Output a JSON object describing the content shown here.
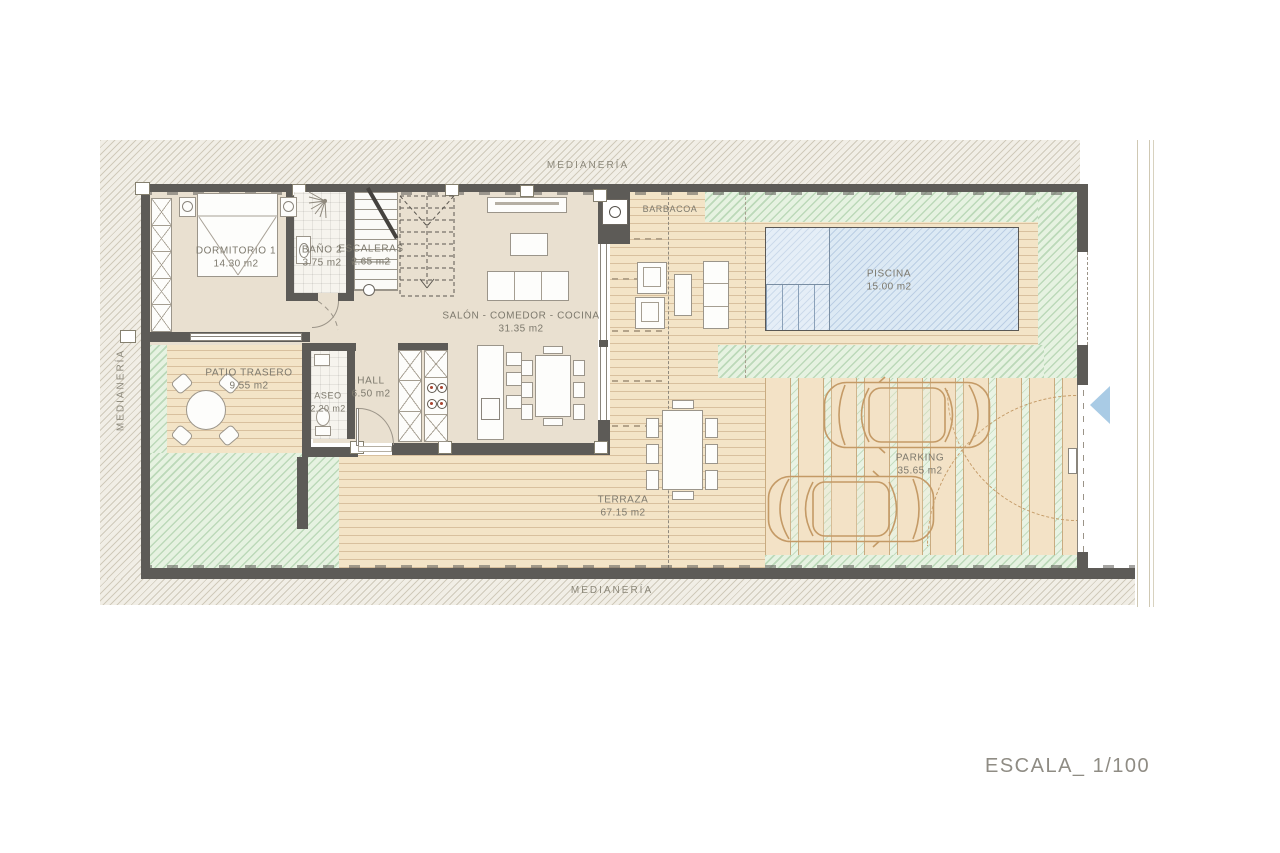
{
  "drawing": {
    "scale_label": "ESCALA_ 1/100",
    "boundary_top": "MEDIANERÍA",
    "boundary_left": "MEDIANERÍA",
    "boundary_bottom": "MEDIANERÍA"
  },
  "rooms": {
    "dormitorio1": {
      "name": "DORMITORIO 1",
      "area": "14.30 m2"
    },
    "bano2": {
      "name": "BAÑO 2",
      "area": "3.75 m2"
    },
    "escaleras": {
      "name": "ESCALERAS",
      "area": "2.65 m2"
    },
    "salon": {
      "name": "SALÓN - COMEDOR - COCINA",
      "area": "31.35 m2"
    },
    "patio": {
      "name": "PATIO TRASERO",
      "area": "9.55 m2"
    },
    "aseo": {
      "name": "ASEO",
      "area": "2.20 m2"
    },
    "hall": {
      "name": "HALL",
      "area": "6.50 m2"
    },
    "terraza": {
      "name": "TERRAZA",
      "area": "67.15 m2"
    },
    "piscina": {
      "name": "PISCINA",
      "area": "15.00 m2"
    },
    "parking": {
      "name": "PARKING",
      "area": "35.65 m2"
    },
    "barbacoa": {
      "name": "BARBACOA"
    }
  },
  "colors": {
    "wall": "#5d5b57",
    "floor": "#e9e0d0",
    "deck": "#f3e4c7",
    "garden_green": "#e6f2e1",
    "pool_blue": "#dce9f4",
    "car_outline": "#c49a66",
    "entry_arrow": "#a9cbe5"
  }
}
